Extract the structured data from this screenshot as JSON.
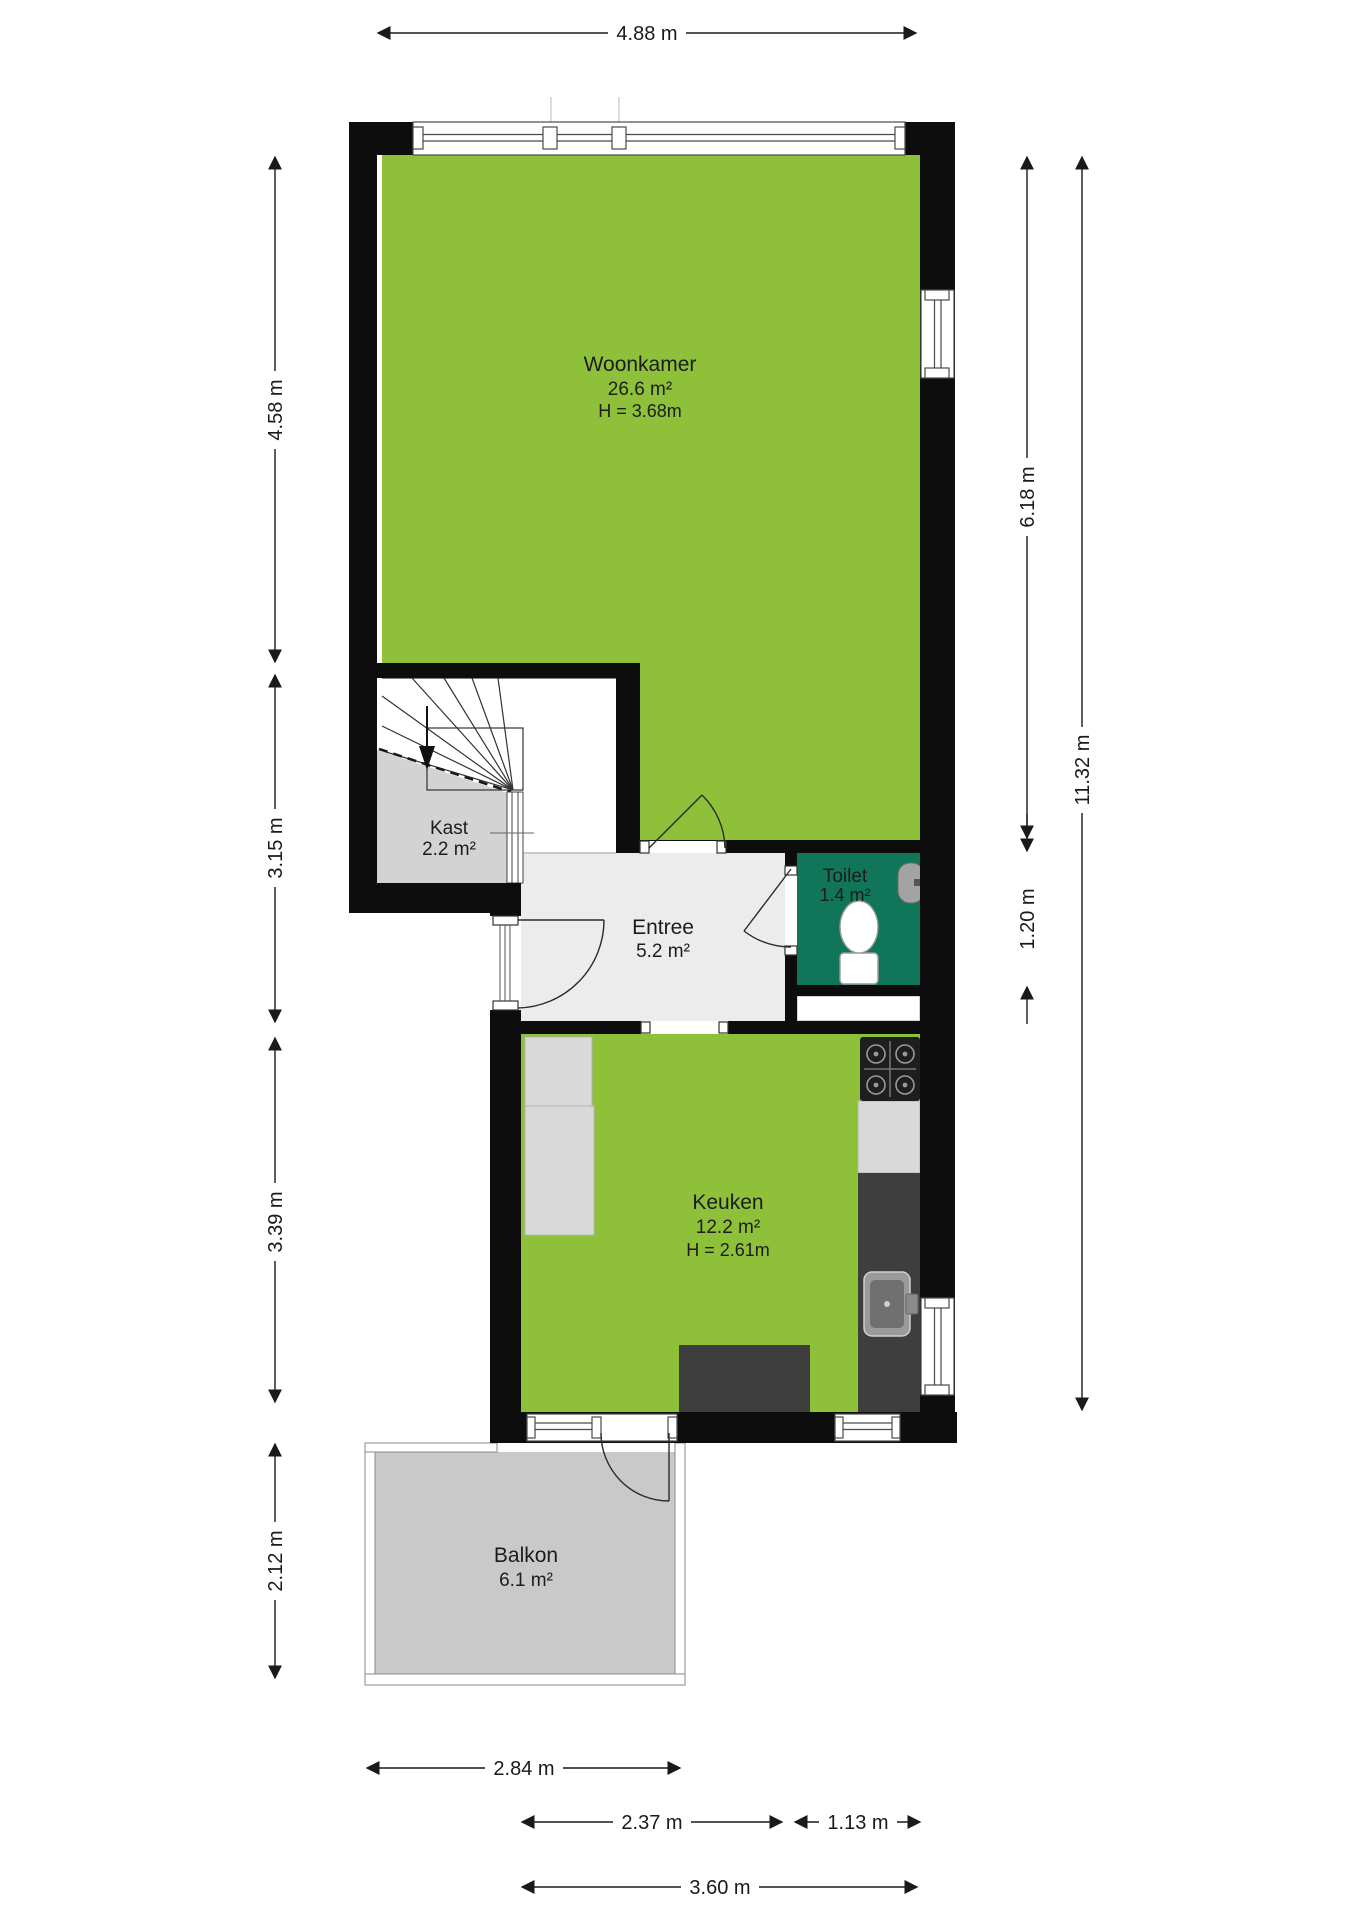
{
  "title": "Floor plan with dimensions",
  "colors": {
    "wall_black": "#0D0D0D",
    "room_green": "#8FC03A",
    "toilet_teal": "#107559",
    "entree_floor": "#ECECEC",
    "kast_floor": "#D3D3D3",
    "balkon_floor": "#C9C9C9",
    "counter_dark": "#3E3E3E",
    "appliance_light": "#D9D9D9"
  },
  "rooms": {
    "woonkamer": {
      "name": "Woonkamer",
      "area": "26.6 m²",
      "height": "H = 3.68m"
    },
    "kast": {
      "name": "Kast",
      "area": "2.2 m²"
    },
    "entree": {
      "name": "Entree",
      "area": "5.2 m²"
    },
    "toilet": {
      "name": "Toilet",
      "area": "1.4 m²"
    },
    "keuken": {
      "name": "Keuken",
      "area": "12.2 m²",
      "height": "H = 2.61m"
    },
    "balkon": {
      "name": "Balkon",
      "area": "6.1 m²"
    }
  },
  "dimensions": {
    "top": "4.88 m",
    "left": [
      "4.58 m",
      "3.15 m",
      "3.39 m",
      "2.12 m"
    ],
    "right": [
      "6.18 m",
      "1.20 m",
      "11.32 m"
    ],
    "bottom": [
      "2.84 m",
      "2.37 m",
      "1.13 m",
      "3.60 m"
    ]
  }
}
